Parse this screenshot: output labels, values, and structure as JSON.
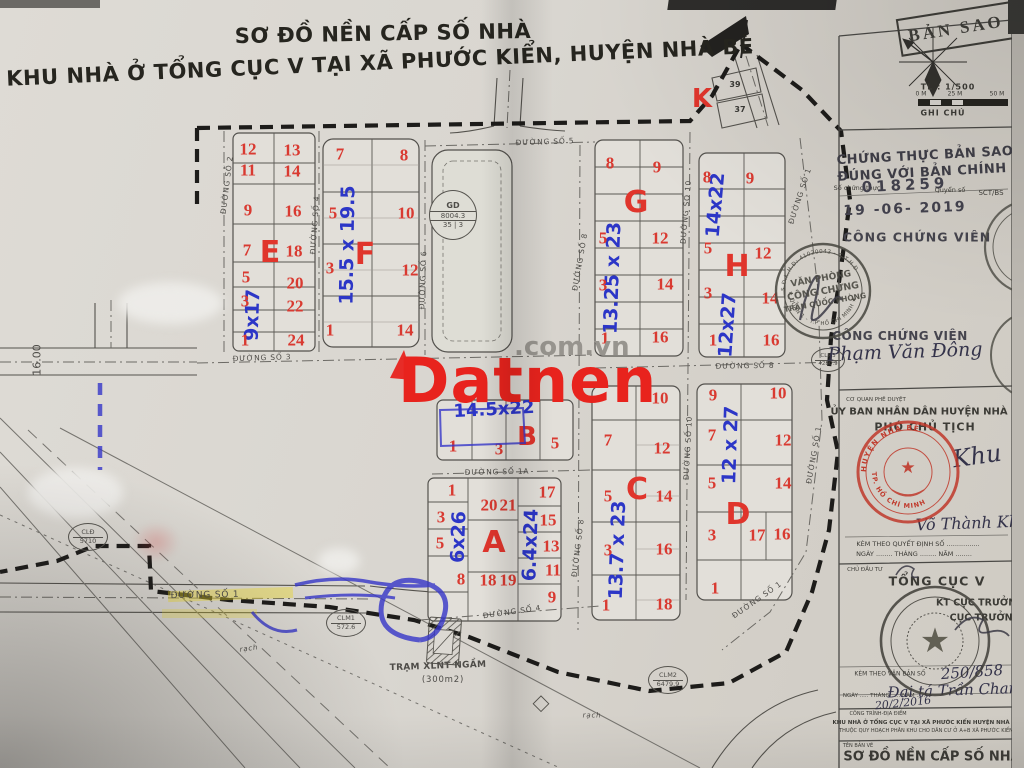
{
  "title": {
    "line1": "SƠ ĐỒ NỀN CẤP SỐ NHÀ",
    "line2": "KHU NHÀ Ở TỔNG CỤC V TẠI XÃ PHƯỚC KIỂN, HUYỆN NHÀ BÈ"
  },
  "watermark": {
    "brand": "Datnen",
    "suffix": ".com.vn"
  },
  "colors": {
    "paper": "#d9d6d0",
    "plot_red": "#d93a31",
    "dim_blue": "#2c36c7",
    "stamp_black": "#4b4a43",
    "stamp_red": "#c0392b",
    "boundary": "#1d1c1a",
    "watermark_red": "#e8231d"
  },
  "legend": {
    "ban_sao": "BẢN SAO",
    "scale": "TL : 1/500",
    "m0": "0 M",
    "m25": "25 M",
    "m50": "50 M",
    "ghi_chu": "GHI CHÚ"
  },
  "cert": {
    "l1": "CHỨNG THỰC BẢN SAO",
    "l2": "ĐÚNG VỚI BẢN CHÍNH",
    "so_label": "Số chứng thực",
    "number": "018259",
    "quyen": "Quyển số",
    "sct": "SCT/BS",
    "date": "19 -06- 2019",
    "role": "CÔNG CHỨNG VIÊN",
    "role2": "CÔNG CHỨNG VIÊN",
    "name": "Phạm Văn Đông"
  },
  "notary_stamp": {
    "l1": "VĂN PHÒNG",
    "l2": "CÔNG CHỨNG",
    "l3": "TRẦN QUỐC PHÒNG",
    "ring_top": "S.Đ.K.H.Đ: 41020043 - C.T.H.Đ",
    "ring_bottom": "★ QUẬN 1 - T.P HỒ CHÍ MINH ★"
  },
  "approval": {
    "header": "CƠ QUAN PHÊ DUYỆT",
    "org": "ỦY BAN NHÂN DÂN HUYỆN NHÀ BÈ",
    "role": "PHÓ CHỦ TỊCH",
    "sig": "Khu",
    "name": "Võ Thành Kh.",
    "attach": "KÈM THEO QUYẾT ĐỊNH SỐ ................",
    "date_blank": "NGÀY ........ THÁNG ........ NĂM ........",
    "stamp_top": "HUYỆN NHÀ BÈ",
    "stamp_bottom": "TP. HỒ CHÍ MINH"
  },
  "investor": {
    "header": "CHỦ ĐẦU TƯ",
    "org": "TỔNG CỤC V",
    "role1": "KT CỤC TRƯỞNG",
    "role2": "CỤC TRƯỞNG",
    "attach": "KÈM THEO VĂN BẢN SỐ",
    "number": "250/858",
    "rank_name": "Đại tá Trần Chan...",
    "date_label": "NGÀY ..... THÁNG ..... NĂM .....",
    "date": "20/2/2016"
  },
  "project": {
    "header": "CÔNG TRÌNH-ĐỊA ĐIỂM",
    "l1": "KHU NHÀ Ở TỔNG CỤC V TẠI XÃ PHƯỚC KIỂN HUYỆN NHÀ BÈ",
    "l2": "THUỘC QUY HOẠCH PHÂN KHU CHO DÂN CƯ Ở A+B XÃ PHƯỚC KIỂN"
  },
  "drawing": {
    "header": "TÊN BẢN VẼ",
    "name": "SƠ ĐỒ NỀN CẤP SỐ NHÀ"
  },
  "streets": {
    "s1": "ĐƯỜNG SỐ 1",
    "s1a": "ĐƯỜNG SỐ 1A",
    "s2": "ĐƯỜNG SỐ 2",
    "s3": "ĐƯỜNG SỐ 3",
    "s4": "ĐƯỜNG SỐ 4",
    "s5": "ĐƯỜNG SỐ 5",
    "s6": "ĐƯỜNG SỐ 6",
    "s8": "ĐƯỜNG SỐ 8",
    "s10": "ĐƯỜNG SỐ 10"
  },
  "blocks": {
    "A": {
      "label": "A",
      "dim_left": "6x26",
      "dim_right": "6.4x24",
      "left": [
        "1",
        "3",
        "5",
        "8"
      ],
      "mid_top": [
        "20",
        "21"
      ],
      "mid_bottom": [
        "18",
        "19"
      ],
      "right": [
        "17",
        "15",
        "13",
        "11",
        "9"
      ]
    },
    "B": {
      "label": "B",
      "dim": "14.5x22",
      "plots": [
        "1",
        "3",
        "5"
      ]
    },
    "C": {
      "label": "C",
      "dim": "13.7 x 23",
      "left": [
        "7",
        "5",
        "3",
        "1"
      ],
      "right": [
        "10",
        "12",
        "14",
        "16",
        "18"
      ]
    },
    "D": {
      "label": "D",
      "dim": "12 x 27",
      "left": [
        "9",
        "7",
        "5",
        "3",
        "1"
      ],
      "right": [
        "10",
        "12",
        "14"
      ],
      "pair": [
        "17",
        "16"
      ]
    },
    "E": {
      "label": "E",
      "dim": "9x17",
      "left": [
        "12",
        "11",
        "9",
        "7",
        "5",
        "3",
        "1"
      ],
      "right": [
        "13",
        "14",
        "16",
        "18",
        "20",
        "22",
        "24"
      ]
    },
    "F": {
      "label": "F",
      "dim": "15.5 x 19.5",
      "left": [
        "7",
        "5",
        "3",
        "1"
      ],
      "right": [
        "8",
        "10",
        "12",
        "14"
      ]
    },
    "G": {
      "label": "G",
      "dim": "13.25 x 23",
      "left": [
        "8",
        "5",
        "3",
        "1"
      ],
      "right": [
        "9",
        "12",
        "14",
        "16"
      ]
    },
    "H": {
      "label": "H",
      "dim_top": "14x22",
      "dim_bottom": "12x27",
      "left": [
        "8",
        "5",
        "3",
        "1"
      ],
      "right": [
        "9",
        "12",
        "14",
        "16"
      ]
    },
    "K": {
      "label": "K",
      "plots": [
        "39",
        "37"
      ]
    }
  },
  "annotations": {
    "dim16": "16.00",
    "cld": "CLĐ",
    "cld_v": "5710",
    "clm1": "CLM1",
    "clm1_v": "572.6",
    "clm2": "CLM2",
    "clm2_v": "6479.9",
    "clm3": "CLM3",
    "clm3_v": "4280.9",
    "gd": "GD",
    "gd_v": "8004.3",
    "gd_sub": "35 | 3",
    "tram": "TRẠM XLNT NGẦM",
    "tram_area": "(300m2)",
    "rach": "rạch"
  }
}
